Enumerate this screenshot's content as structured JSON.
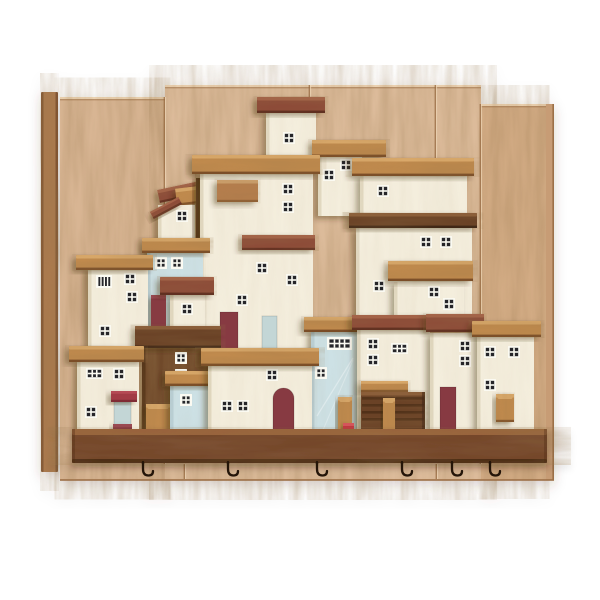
{
  "artwork": {
    "kind": "product-photo",
    "subject": "wooden-village-key-holder-wall-decor",
    "background_color": "#ffffff",
    "palette": {
      "rail": "#ab7a4f",
      "rail_dark": "#7c5130",
      "rail_light": "#c59a70",
      "panel_left": "#d8b593",
      "panel_center": "#dcbb9a",
      "panel_right": "#d2ab84",
      "panel_seam": "#96683f",
      "panel_bevel": "#eed6b6",
      "panel_edge": "#9c6f47",
      "shelf": "#74462a",
      "shelf_top": "#99643c",
      "shelf_dark": "#4c2c15",
      "cream": "#f4eedd",
      "cream_shade": "#ddd4bb",
      "blue": "#cde1e5",
      "blue_shade": "#b6cdd3",
      "paleblue": "#c3d6d6",
      "brown_house": "#6f4a2c",
      "brown_dark": "#523218",
      "oak": "#c08a4e",
      "oak_light": "#daa96a",
      "oak_dark": "#7a4c26",
      "walnut": "#6a4227",
      "walnut_light": "#8a5c38",
      "walnut_dark": "#3f2615",
      "mahogany": "#8d4c38",
      "mahogany_light": "#a56248",
      "mahogany_dark": "#5e2d1f",
      "oaksign": "#b67e4d",
      "oaksign_light": "#cda06c",
      "oaksign_dark": "#8a5a30",
      "maroon": "#873a42",
      "red": "#c2383f",
      "redsign": "#a23a45",
      "window_frame": "#fbfaf2",
      "window_pane": "#26262a",
      "hook": "#241509"
    },
    "panel": {
      "left_rail": {
        "x": 41,
        "y": 92,
        "w": 17,
        "h": 380
      },
      "planks": [
        {
          "x": 60,
          "y": 97,
          "w": 105,
          "h": 383,
          "fill": "panel_left"
        },
        {
          "x": 165,
          "y": 85,
          "w": 316,
          "h": 395,
          "fill": "panel_center"
        },
        {
          "x": 481,
          "y": 104,
          "w": 65,
          "h": 376,
          "fill": "panel_right"
        }
      ],
      "right_rail": {
        "x": 546,
        "y": 104,
        "w": 8,
        "h": 376
      },
      "joints": [
        {
          "x": 165,
          "y1": 97,
          "y2": 464
        },
        {
          "x": 481,
          "y1": 104,
          "y2": 464
        },
        {
          "x": 310,
          "y1": 85,
          "y2": 141
        },
        {
          "x": 436,
          "y1": 85,
          "y2": 160
        },
        {
          "x": 185,
          "y1": 464,
          "y2": 479
        },
        {
          "x": 437,
          "y1": 464,
          "y2": 479
        }
      ],
      "bottom_edge_y": 479
    },
    "shelf": {
      "x": 72,
      "y": 429,
      "w": 475,
      "h": 34
    },
    "hooks": {
      "count": 6,
      "y": 462,
      "xs": [
        143,
        228,
        317,
        402,
        452,
        490
      ]
    },
    "houses": [
      {
        "name": "rubble-roof-pile",
        "blocks": [
          {
            "x": 158,
            "y": 184,
            "w": 58,
            "h": 13,
            "wood": "mahogany",
            "rot": -12
          },
          {
            "x": 176,
            "y": 186,
            "w": 46,
            "h": 17,
            "wood": "oak",
            "rot": -7
          }
        ]
      },
      {
        "name": "gable-house",
        "body": {
          "x": 158,
          "y": 205,
          "w": 37,
          "h": 52,
          "fill": "cream"
        },
        "windows": [
          {
            "x": 176,
            "y": 210,
            "t": "t22"
          }
        ],
        "blocks": [
          {
            "x": 150,
            "y": 204,
            "w": 32,
            "h": 8,
            "wood": "mahogany",
            "rot": -28
          }
        ]
      },
      {
        "name": "brown-post-house",
        "body": {
          "x": 196,
          "y": 178,
          "w": 20,
          "h": 76,
          "fill": "brown"
        }
      },
      {
        "name": "top-house",
        "body": {
          "x": 266,
          "y": 112,
          "w": 50,
          "h": 58,
          "fill": "cream"
        },
        "roof": {
          "x": 257,
          "y": 97,
          "w": 68,
          "h": 16,
          "wood": "mahogany"
        },
        "windows": [
          {
            "x": 283,
            "y": 132,
            "t": "t22"
          }
        ]
      },
      {
        "name": "upper-right-house",
        "body": {
          "x": 318,
          "y": 156,
          "w": 44,
          "h": 60,
          "fill": "cream"
        },
        "roof": {
          "x": 312,
          "y": 140,
          "w": 74,
          "h": 17,
          "wood": "oak"
        },
        "windows": [
          {
            "x": 340,
            "y": 159,
            "t": "t22"
          },
          {
            "x": 323,
            "y": 169,
            "t": "t22"
          }
        ]
      },
      {
        "name": "tall-center-house",
        "body": {
          "x": 200,
          "y": 172,
          "w": 113,
          "h": 178,
          "fill": "cream"
        },
        "roof": {
          "x": 192,
          "y": 155,
          "w": 128,
          "h": 19,
          "wood": "oak"
        },
        "windows": [
          {
            "x": 282,
            "y": 183,
            "t": "t22"
          },
          {
            "x": 282,
            "y": 201,
            "t": "t22"
          },
          {
            "x": 256,
            "y": 262,
            "t": "t22"
          },
          {
            "x": 286,
            "y": 274,
            "t": "t22"
          },
          {
            "x": 236,
            "y": 294,
            "t": "t22"
          }
        ],
        "doors": [
          {
            "x": 220,
            "y": 312,
            "w": 18,
            "h": 37,
            "fill": "maroon"
          },
          {
            "x": 262,
            "y": 316,
            "w": 15,
            "h": 33,
            "fill": "paleblue"
          }
        ],
        "blocks": [
          {
            "x": 217,
            "y": 180,
            "w": 41,
            "h": 22,
            "wood": "oaksign"
          },
          {
            "x": 242,
            "y": 235,
            "w": 73,
            "h": 15,
            "wood": "mahogany"
          }
        ]
      },
      {
        "name": "wide-upper-right-house",
        "body": {
          "x": 360,
          "y": 175,
          "w": 107,
          "h": 42,
          "fill": "cream"
        },
        "roof": {
          "x": 352,
          "y": 158,
          "w": 122,
          "h": 18,
          "wood": "oak"
        },
        "windows": [
          {
            "x": 377,
            "y": 185,
            "t": "t22"
          }
        ]
      },
      {
        "name": "wide-mid-right-house",
        "body": {
          "x": 356,
          "y": 228,
          "w": 116,
          "h": 94,
          "fill": "cream"
        },
        "roof": {
          "x": 349,
          "y": 213,
          "w": 128,
          "h": 15,
          "wood": "walnut"
        },
        "windows": [
          {
            "x": 420,
            "y": 236,
            "t": "t22"
          },
          {
            "x": 440,
            "y": 236,
            "t": "t22"
          },
          {
            "x": 373,
            "y": 280,
            "t": "t22"
          }
        ]
      },
      {
        "name": "terrace-house-right",
        "body": {
          "x": 394,
          "y": 282,
          "w": 70,
          "h": 44,
          "fill": "cream"
        },
        "roof": {
          "x": 388,
          "y": 261,
          "w": 85,
          "h": 20,
          "wood": "oak"
        },
        "windows": [
          {
            "x": 428,
            "y": 286,
            "t": "t22"
          },
          {
            "x": 443,
            "y": 298,
            "t": "t22"
          }
        ]
      },
      {
        "name": "blue-back-left-house",
        "body": {
          "x": 147,
          "y": 246,
          "w": 56,
          "h": 86,
          "fill": "blue"
        },
        "roof": {
          "x": 142,
          "y": 238,
          "w": 68,
          "h": 15,
          "wood": "oak"
        },
        "windows": [
          {
            "x": 155,
            "y": 257,
            "t": "t22w"
          },
          {
            "x": 171,
            "y": 257,
            "t": "t22w"
          }
        ]
      },
      {
        "name": "mahogany-roof-cottage",
        "body": {
          "x": 170,
          "y": 295,
          "w": 35,
          "h": 37,
          "fill": "cream"
        },
        "roof": {
          "x": 160,
          "y": 277,
          "w": 54,
          "h": 18,
          "wood": "mahogany"
        },
        "windows": [
          {
            "x": 181,
            "y": 303,
            "t": "t22"
          }
        ],
        "blocks": [
          {
            "x": 151,
            "y": 295,
            "w": 15,
            "h": 37,
            "wood": "maroonblock"
          }
        ]
      },
      {
        "name": "left-house",
        "body": {
          "x": 88,
          "y": 268,
          "w": 60,
          "h": 80,
          "fill": "cream"
        },
        "roof": {
          "x": 76,
          "y": 255,
          "w": 77,
          "h": 15,
          "wood": "oak"
        },
        "windows": [
          {
            "x": 96,
            "y": 275,
            "t": "slat"
          },
          {
            "x": 124,
            "y": 273,
            "t": "t22"
          },
          {
            "x": 126,
            "y": 291,
            "t": "t22"
          },
          {
            "x": 99,
            "y": 325,
            "t": "t22"
          }
        ]
      },
      {
        "name": "brown-grain-house",
        "body": {
          "x": 142,
          "y": 348,
          "w": 76,
          "h": 85,
          "fill": "brown"
        },
        "roof": {
          "x": 135,
          "y": 326,
          "w": 86,
          "h": 22,
          "wood": "walnut"
        },
        "windows": [
          {
            "x": 175,
            "y": 352,
            "t": "t22w"
          },
          {
            "x": 175,
            "y": 369,
            "t": "t22w"
          }
        ]
      },
      {
        "name": "blue-center-house",
        "body": {
          "x": 311,
          "y": 330,
          "w": 46,
          "h": 103,
          "fill": "blue",
          "rays": true
        },
        "roof": {
          "x": 304,
          "y": 317,
          "w": 59,
          "h": 15,
          "wood": "oak"
        },
        "windows": [
          {
            "x": 327,
            "y": 337,
            "t": "t42w"
          },
          {
            "x": 315,
            "y": 367,
            "t": "t22w"
          }
        ]
      },
      {
        "name": "barn-door-house",
        "body": {
          "x": 357,
          "y": 328,
          "w": 73,
          "h": 105,
          "fill": "cream"
        },
        "roof": {
          "x": 352,
          "y": 315,
          "w": 81,
          "h": 15,
          "wood": "mahogany"
        },
        "windows": [
          {
            "x": 367,
            "y": 338,
            "t": "t22"
          },
          {
            "x": 391,
            "y": 343,
            "t": "t32"
          },
          {
            "x": 367,
            "y": 354,
            "t": "t22"
          }
        ],
        "blocks": [
          {
            "x": 361,
            "y": 381,
            "w": 47,
            "h": 11,
            "wood": "oak"
          },
          {
            "x": 361,
            "y": 392,
            "w": 64,
            "h": 39,
            "wood": "slats"
          },
          {
            "x": 383,
            "y": 398,
            "w": 12,
            "h": 34,
            "wood": "oakpeg"
          }
        ]
      },
      {
        "name": "right-inner-house",
        "body": {
          "x": 430,
          "y": 333,
          "w": 47,
          "h": 98,
          "fill": "cream"
        },
        "roof": {
          "x": 426,
          "y": 314,
          "w": 58,
          "h": 18,
          "wood": "mahogany"
        },
        "windows": [
          {
            "x": 459,
            "y": 340,
            "t": "t22"
          },
          {
            "x": 459,
            "y": 355,
            "t": "t22"
          }
        ],
        "doors": [
          {
            "x": 440,
            "y": 387,
            "w": 16,
            "h": 44,
            "fill": "maroon"
          }
        ]
      },
      {
        "name": "right-outer-house",
        "body": {
          "x": 477,
          "y": 333,
          "w": 57,
          "h": 98,
          "fill": "cream"
        },
        "roof": {
          "x": 472,
          "y": 321,
          "w": 69,
          "h": 16,
          "wood": "oak"
        },
        "windows": [
          {
            "x": 484,
            "y": 346,
            "t": "t22"
          },
          {
            "x": 508,
            "y": 346,
            "t": "t22"
          },
          {
            "x": 484,
            "y": 379,
            "t": "t22"
          }
        ],
        "blocks": [
          {
            "x": 496,
            "y": 394,
            "w": 18,
            "h": 28,
            "wood": "oakpeg"
          }
        ]
      },
      {
        "name": "front-left-house",
        "body": {
          "x": 77,
          "y": 360,
          "w": 62,
          "h": 77,
          "fill": "cream"
        },
        "roof": {
          "x": 69,
          "y": 346,
          "w": 75,
          "h": 16,
          "wood": "oak"
        },
        "windows": [
          {
            "x": 86,
            "y": 368,
            "t": "t32"
          },
          {
            "x": 113,
            "y": 368,
            "t": "t22"
          },
          {
            "x": 85,
            "y": 406,
            "t": "t22"
          }
        ],
        "doors": [
          {
            "x": 114,
            "y": 402,
            "w": 17,
            "h": 26,
            "fill": "paleblue"
          }
        ],
        "blocks": [
          {
            "x": 111,
            "y": 391,
            "w": 26,
            "h": 11,
            "wood": "redsign"
          },
          {
            "x": 113,
            "y": 424,
            "w": 19,
            "h": 13,
            "wood": "maroonblock"
          }
        ]
      },
      {
        "name": "oak-peg-left",
        "blocks": [
          {
            "x": 146,
            "y": 404,
            "w": 24,
            "h": 33,
            "wood": "oakpeg"
          }
        ]
      },
      {
        "name": "blue-front-left-house",
        "body": {
          "x": 170,
          "y": 384,
          "w": 42,
          "h": 53,
          "fill": "blue"
        },
        "roof": {
          "x": 165,
          "y": 371,
          "w": 52,
          "h": 15,
          "wood": "oak"
        },
        "windows": [
          {
            "x": 180,
            "y": 394,
            "t": "t22w"
          }
        ]
      },
      {
        "name": "arch-door-house",
        "body": {
          "x": 208,
          "y": 364,
          "w": 104,
          "h": 69,
          "fill": "cream"
        },
        "roof": {
          "x": 201,
          "y": 348,
          "w": 118,
          "h": 18,
          "wood": "oak"
        },
        "windows": [
          {
            "x": 266,
            "y": 369,
            "t": "t22"
          },
          {
            "x": 221,
            "y": 400,
            "t": "t22"
          },
          {
            "x": 237,
            "y": 400,
            "t": "t22"
          }
        ],
        "doors": [
          {
            "x": 273,
            "y": 388,
            "w": 21,
            "h": 45,
            "fill": "maroon",
            "arch": true
          }
        ]
      },
      {
        "name": "peg-and-red-cube",
        "blocks": [
          {
            "x": 338,
            "y": 397,
            "w": 14,
            "h": 35,
            "wood": "oakpeg"
          },
          {
            "x": 343,
            "y": 423,
            "w": 11,
            "h": 12,
            "wood": "redcube"
          }
        ]
      }
    ]
  }
}
